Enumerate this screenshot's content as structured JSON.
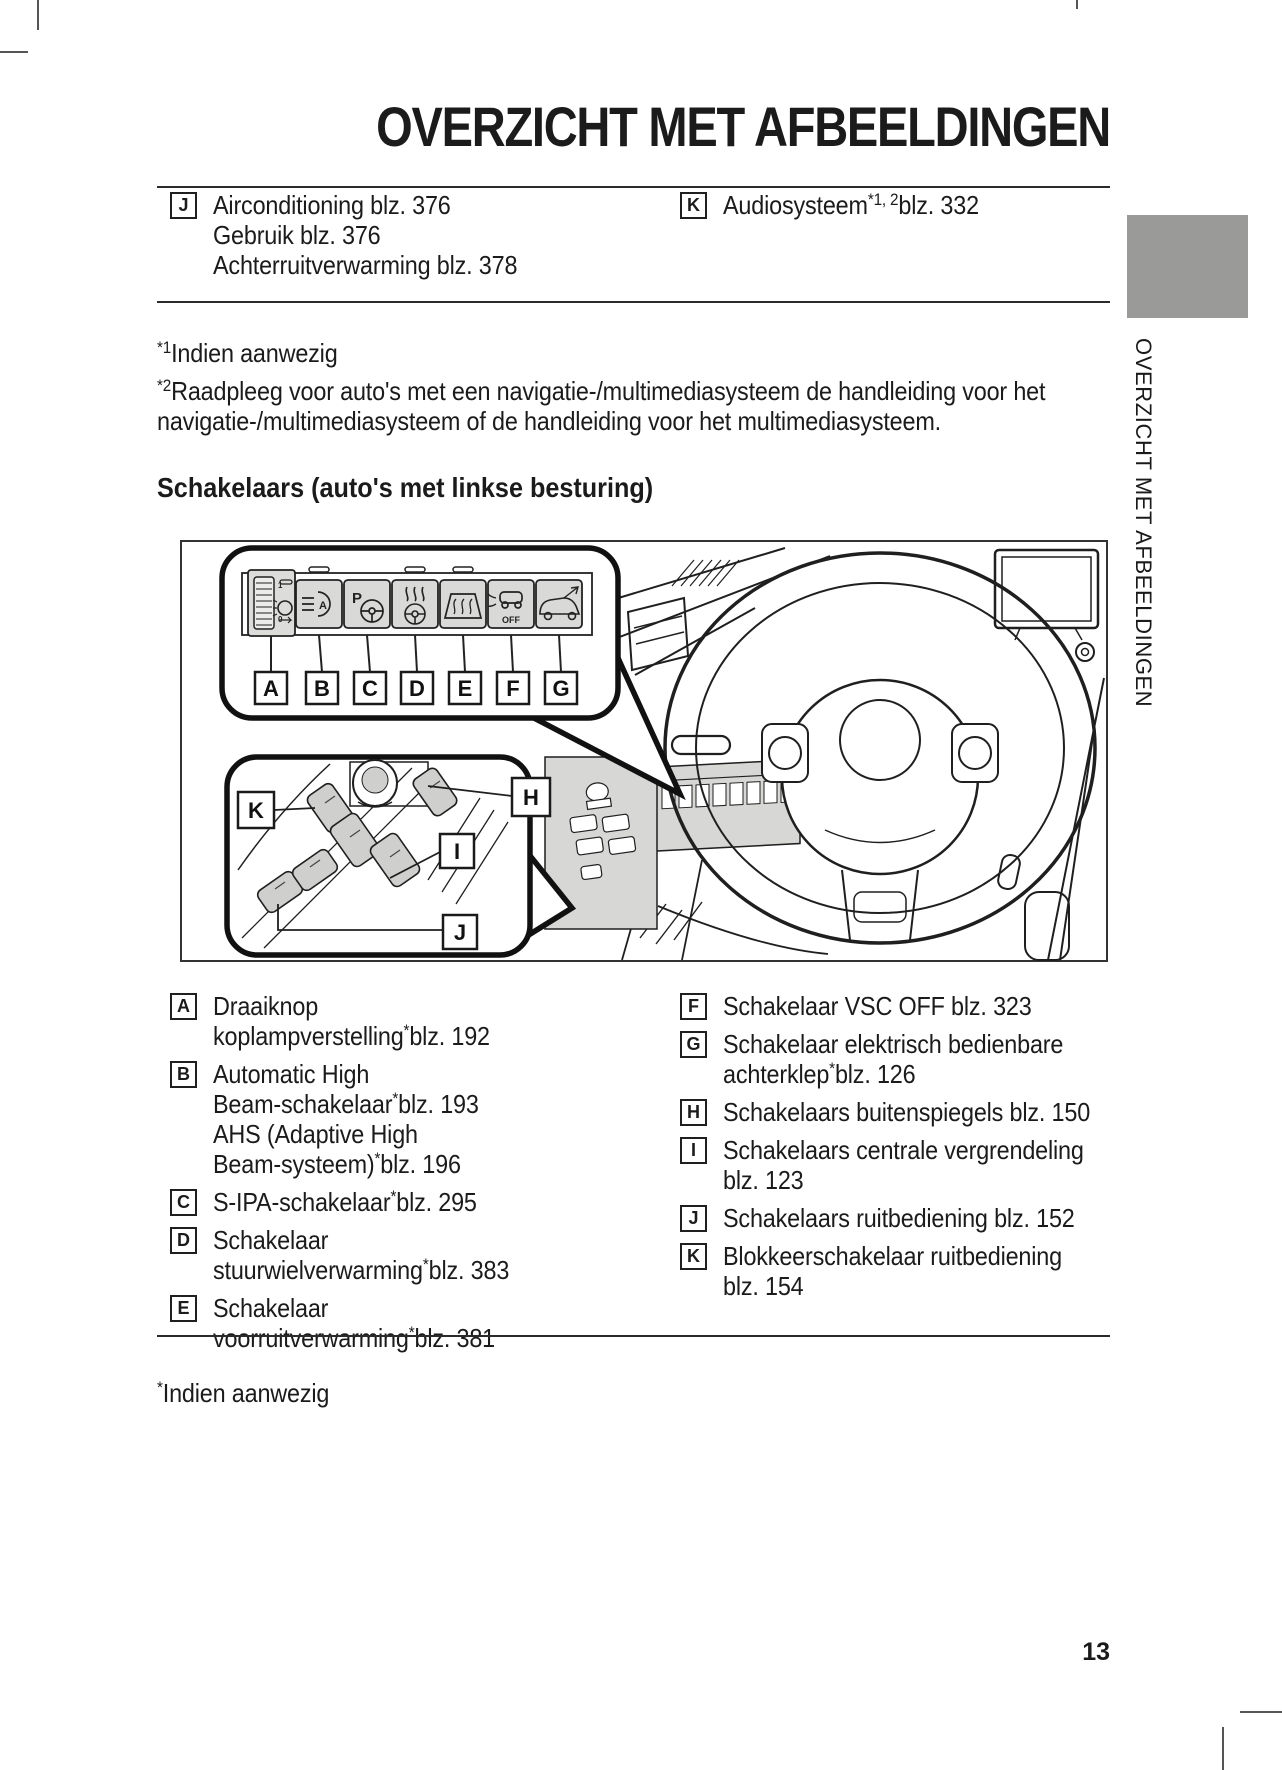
{
  "title": "OVERZICHT MET AFBEELDINGEN",
  "sidebar": {
    "tab_label": "OVERZICHT MET AFBEELDINGEN"
  },
  "colors": {
    "tab_gray": "#9a9a98",
    "panel_gray": "#d7d7d5",
    "key_gray": "#cfcfcd",
    "text": "#1b1b1b"
  },
  "top_legend": {
    "items": [
      {
        "letter": "J",
        "lines": [
          "Airconditioning blz. 376",
          "Gebruik blz. 376",
          "Achterruitverwarming blz. 378"
        ]
      },
      {
        "letter": "K",
        "lines": [
          "Audiosysteem^{*1, 2}blz. 332"
        ]
      }
    ]
  },
  "footnotes_top": [
    {
      "lines": [
        "^{*1}Indien aanwezig"
      ]
    },
    {
      "lines": [
        "^{*2}Raadpleeg voor auto's met een navigatie-/multimediasysteem de handleiding voor het",
        "navigatie-/multimediasysteem of de handleiding voor het multimediasysteem."
      ]
    }
  ],
  "section_heading": "Schakelaars (auto's met linkse besturing)",
  "figure": {
    "callout_labels": [
      "A",
      "B",
      "C",
      "D",
      "E",
      "F",
      "G",
      "H",
      "I",
      "J",
      "K"
    ],
    "button_icons": [
      "headlight-leveling-dial-icon",
      "automatic-high-beam-icon",
      "s-ipa-parking-icon",
      "steering-wheel-heating-icon",
      "windshield-heating-icon",
      "vsc-off-icon",
      "power-tailgate-icon"
    ],
    "icon_texts": {
      "s_ipa_p": "P",
      "vsc_off": "OFF",
      "dial_1": "1",
      "dial_0": "0"
    }
  },
  "bottom_legend": {
    "left": [
      {
        "letter": "A",
        "lines": [
          "Draaiknop",
          "koplampverstelling^{*}blz. 192"
        ]
      },
      {
        "letter": "B",
        "lines": [
          "Automatic High",
          "Beam-schakelaar^{*}blz. 193",
          "AHS (Adaptive High",
          "Beam-systeem)^{*}blz. 196"
        ]
      },
      {
        "letter": "C",
        "lines": [
          "S-IPA-schakelaar^{*}blz. 295"
        ]
      },
      {
        "letter": "D",
        "lines": [
          "Schakelaar",
          "stuurwielverwarming^{*}blz. 383"
        ]
      },
      {
        "letter": "E",
        "lines": [
          "Schakelaar",
          "voorruitverwarming^{*}blz. 381"
        ]
      }
    ],
    "right": [
      {
        "letter": "F",
        "lines": [
          "Schakelaar VSC OFF blz. 323"
        ]
      },
      {
        "letter": "G",
        "lines": [
          "Schakelaar elektrisch bedienbare",
          "achterklep^{*}blz. 126"
        ]
      },
      {
        "letter": "H",
        "lines": [
          "Schakelaars buitenspiegels blz. 150"
        ]
      },
      {
        "letter": "I",
        "lines": [
          "Schakelaars centrale vergrendeling",
          "blz. 123"
        ]
      },
      {
        "letter": "J",
        "lines": [
          "Schakelaars ruitbediening blz. 152"
        ]
      },
      {
        "letter": "K",
        "lines": [
          "Blokkeerschakelaar ruitbediening",
          "blz. 154"
        ]
      }
    ]
  },
  "footnote_bottom": {
    "lines": [
      "^{*}Indien aanwezig"
    ]
  },
  "page": {
    "number": "13"
  }
}
